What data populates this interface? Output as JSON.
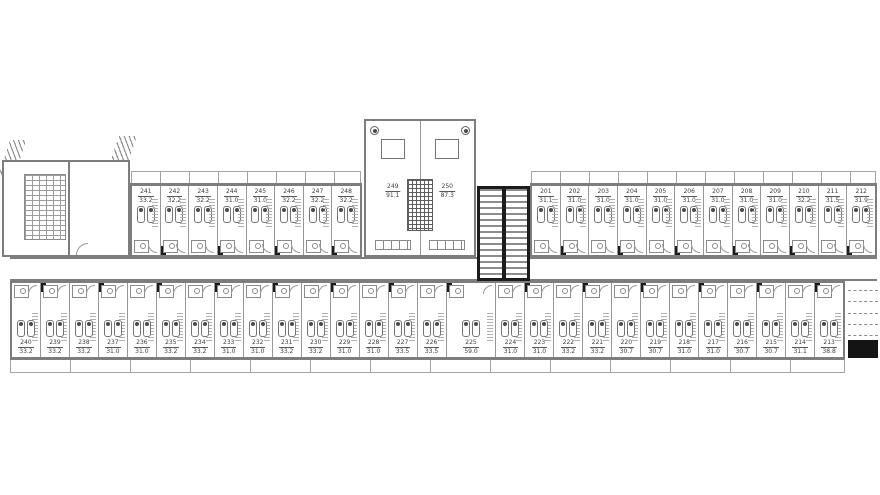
{
  "colors": {
    "background": "#ffffff",
    "wall": "#7d7d7d",
    "partition": "#979797",
    "furniture": "#757575",
    "dark_fill": "#1c1c1c",
    "hatch": "#a3a3a3"
  },
  "rooms_top_left": [
    {
      "number": "241",
      "area": "33.2"
    },
    {
      "number": "242",
      "area": "32.2"
    },
    {
      "number": "243",
      "area": "32.2"
    },
    {
      "number": "244",
      "area": "31.0"
    },
    {
      "number": "245",
      "area": "31.0"
    },
    {
      "number": "246",
      "area": "32.2"
    },
    {
      "number": "247",
      "area": "32.2"
    },
    {
      "number": "248",
      "area": "32.2"
    }
  ],
  "rooms_top_center": [
    {
      "number": "249",
      "area": "91.1"
    },
    {
      "number": "250",
      "area": "87.3"
    }
  ],
  "rooms_top_right": [
    {
      "number": "201",
      "area": "31.1"
    },
    {
      "number": "202",
      "area": "31.0"
    },
    {
      "number": "203",
      "area": "31.0"
    },
    {
      "number": "204",
      "area": "31.0"
    },
    {
      "number": "205",
      "area": "31.0"
    },
    {
      "number": "206",
      "area": "31.0"
    },
    {
      "number": "207",
      "area": "31.0"
    },
    {
      "number": "208",
      "area": "31.0"
    },
    {
      "number": "209",
      "area": "31.0"
    },
    {
      "number": "210",
      "area": "32.2"
    },
    {
      "number": "211",
      "area": "31.5"
    },
    {
      "number": "212",
      "area": "31.9"
    }
  ],
  "rooms_bottom": [
    {
      "number": "240",
      "area": "33.2"
    },
    {
      "number": "239",
      "area": "33.2"
    },
    {
      "number": "238",
      "area": "33.2"
    },
    {
      "number": "237",
      "area": "31.0"
    },
    {
      "number": "236",
      "area": "31.0"
    },
    {
      "number": "235",
      "area": "33.2"
    },
    {
      "number": "234",
      "area": "33.2"
    },
    {
      "number": "233",
      "area": "31.0"
    },
    {
      "number": "232",
      "area": "31.0"
    },
    {
      "number": "231",
      "area": "33.2"
    },
    {
      "number": "230",
      "area": "33.2"
    },
    {
      "number": "229",
      "area": "31.0"
    },
    {
      "number": "228",
      "area": "31.0"
    },
    {
      "number": "227",
      "area": "33.5"
    },
    {
      "number": "226",
      "area": "33.5"
    },
    {
      "number": "225",
      "area": "59.0",
      "wide": true
    },
    {
      "number": "224",
      "area": "31.0"
    },
    {
      "number": "223",
      "area": "31.0"
    },
    {
      "number": "222",
      "area": "33.2"
    },
    {
      "number": "221",
      "area": "33.2"
    },
    {
      "number": "220",
      "area": "30.7"
    },
    {
      "number": "219",
      "area": "30.7"
    },
    {
      "number": "218",
      "area": "31.0"
    },
    {
      "number": "217",
      "area": "31.0"
    },
    {
      "number": "216",
      "area": "30.7"
    },
    {
      "number": "215",
      "area": "30.7"
    },
    {
      "number": "214",
      "area": "31.1"
    },
    {
      "number": "213",
      "area": "38.8"
    }
  ]
}
